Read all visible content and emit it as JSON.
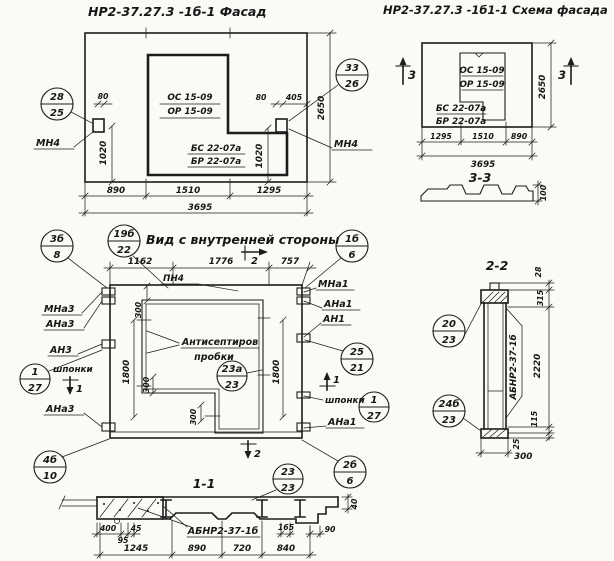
{
  "paper": "#fbfaf6",
  "ink": "#1c1c1c",
  "facade": {
    "title": "НР2-37.27.3 -1б-1 Фасад",
    "win1": "ОС 15-09",
    "win2": "ОР 15-09",
    "sill1": "БС 22-07а",
    "sill2": "БР 22-07а",
    "mn4_left": "МН4",
    "mn4_right": "МН4",
    "co_left": {
      "t": "28",
      "b": "25"
    },
    "co_right": {
      "t": "33",
      "b": "26"
    },
    "d80l": "80",
    "d80r": "80",
    "d405": "405",
    "d1020l": "1020",
    "d1020r": "1020",
    "d2650": "2650",
    "d890": "890",
    "d1510": "1510",
    "d1295": "1295",
    "d3695": "3695"
  },
  "scheme": {
    "title": "НР2-37.27.3 -1б1-1 Схема фасада",
    "win1": "ОС 15-09",
    "win2": "ОР 15-09",
    "sill1": "БС 22-07а",
    "sill2": "БР 22-07а",
    "sec_left": "3",
    "sec_right": "3",
    "d2650": "2650",
    "d1295": "1295",
    "d1510": "1510",
    "d890": "890",
    "d3695": "3695",
    "s33": "3-3",
    "d100": "100"
  },
  "inner": {
    "title": "Вид с внутренней стороны",
    "d1162": "1162",
    "d1776": "1776",
    "d757": "757",
    "sec2_top": "2",
    "sec2_bot": "2",
    "sec1_left": "1",
    "sec1_right": "1",
    "pn4": "ПН4",
    "mna3": "МНа3",
    "ana3_top": "АНа3",
    "an3": "АН3",
    "shponki_left": "шпонки",
    "ana3_bot": "АНа3",
    "mna1": "МНа1",
    "ana1_top": "АНа1",
    "an1": "АН1",
    "shponki_right": "шпонки",
    "ana1_bot": "АНа1",
    "note1": "Антисептиров",
    "note2": "пробки",
    "d1800l": "1800",
    "d1800r": "1800",
    "d300a": "300",
    "d300b": "300",
    "d300c": "300",
    "co_3b8": {
      "t": "3б",
      "b": "8"
    },
    "co_19b22": {
      "t": "19б",
      "b": "22"
    },
    "co_1b6": {
      "t": "1б",
      "b": "6"
    },
    "co_127l": {
      "t": "1",
      "b": "27"
    },
    "co_23a": {
      "t": "23а",
      "b": "23"
    },
    "co_2521": {
      "t": "25",
      "b": "21"
    },
    "co_127r": {
      "t": "1",
      "b": "27"
    },
    "co_4b10": {
      "t": "4б",
      "b": "10"
    },
    "co_2b6": {
      "t": "2б",
      "b": "6"
    },
    "co_2323": {
      "t": "23",
      "b": "23"
    }
  },
  "s22": {
    "title": "2-2",
    "mark": "АБНР2-37-1б",
    "d28": "28",
    "d315": "315",
    "d2220": "2220",
    "d115": "115",
    "d25": "25",
    "d300": "300",
    "co_2023": {
      "t": "20",
      "b": "23"
    },
    "co_24b": {
      "t": "24б",
      "b": "23"
    }
  },
  "s11": {
    "title": "1-1",
    "mark": "АБНР2-37-1б",
    "d400": "400",
    "d95": "95",
    "d45": "45",
    "d1245": "1245",
    "d890": "890",
    "d720": "720",
    "d840": "840",
    "d165": "165",
    "d90": "90",
    "d40": "40"
  }
}
